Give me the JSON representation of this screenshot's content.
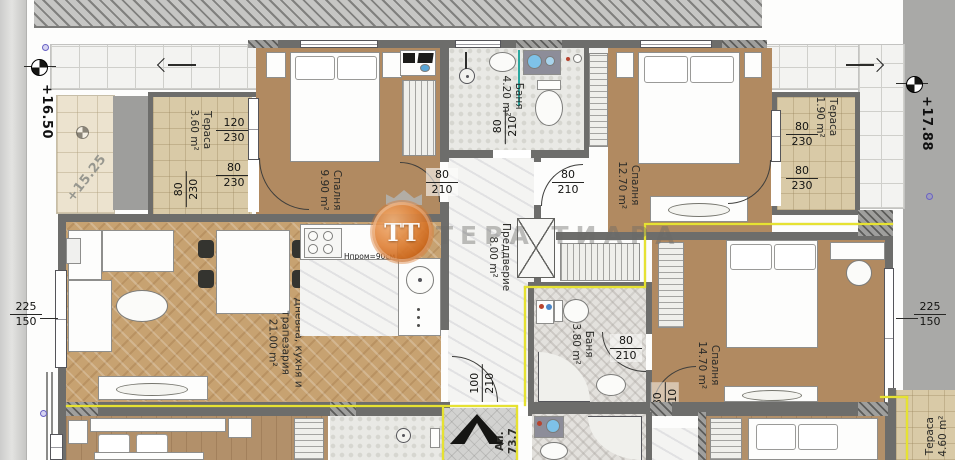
{
  "watermark": {
    "initials": "ТТ",
    "name": "ТЕРА ТИАРА"
  },
  "levels": {
    "walkway_left": "+16.50",
    "walkway_right": "+17.88",
    "slab": "+15.25"
  },
  "apartment": {
    "prefix": "Ап.",
    "area": "73.7"
  },
  "kitchen": {
    "counter_note": "Hпром=90см"
  },
  "rooms": {
    "terrace_tl": {
      "name": "Тераса",
      "area": "3.60 m²"
    },
    "bedroom_tl": {
      "name": "Спалня",
      "area": "9.90 m²"
    },
    "bath_top": {
      "name": "Баня",
      "area": "4.20 m²"
    },
    "bedroom_tr": {
      "name": "Спалня",
      "area": "12.70 m²"
    },
    "terrace_tr": {
      "name": "Тераса",
      "area": "1.90 m²"
    },
    "living": {
      "line1": "Дневна, кухня и",
      "line2": "трапезария",
      "area": "21.00 m²"
    },
    "hall": {
      "name": "Преддверие",
      "area": "8.00 m²"
    },
    "bath_right": {
      "name": "Баня",
      "area": "3.80 m²"
    },
    "bedroom_right": {
      "name": "Спалня",
      "area": "14.70 m²"
    },
    "terrace_br": {
      "name": "Тераса",
      "area": "4.60 m²"
    }
  },
  "dims": {
    "d120_230": {
      "w": "120",
      "h": "230"
    },
    "d80_230": {
      "w": "80",
      "h": "230"
    },
    "d80_210": {
      "w": "80",
      "h": "210"
    },
    "d100_210": {
      "w": "100",
      "h": "210"
    },
    "d225_150": {
      "w": "225",
      "h": "150"
    }
  },
  "colors": {
    "boundary": "#e6e232",
    "wall": "#6d6d6b",
    "logo_orange": "#e08238"
  }
}
